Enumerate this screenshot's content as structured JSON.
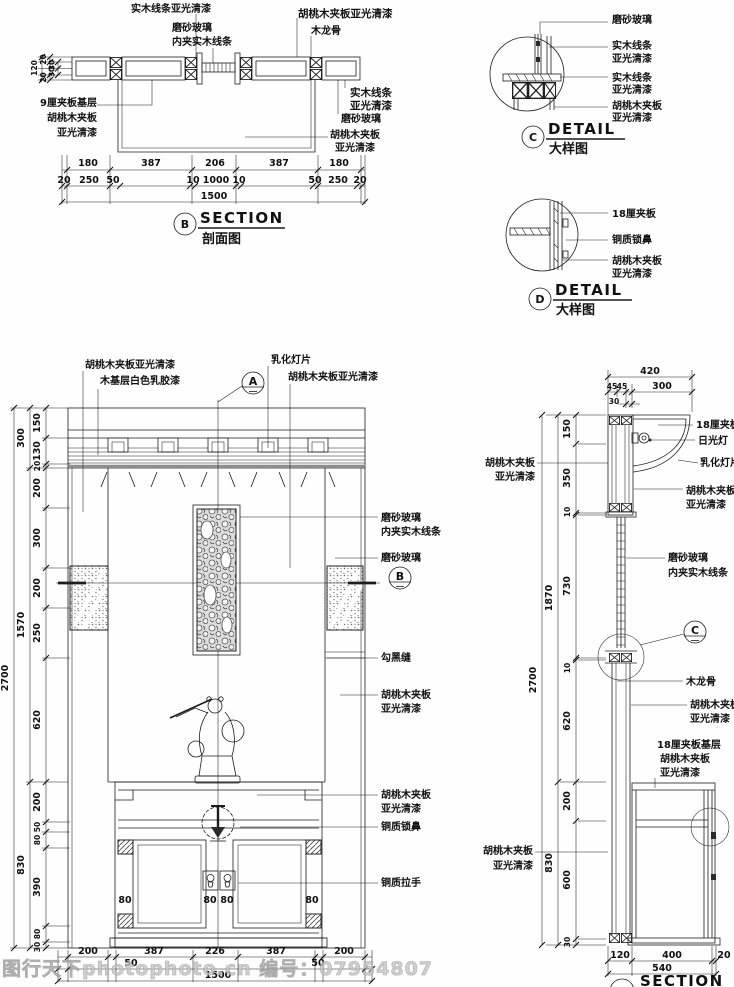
{
  "watermark": "图行天下photophoto.cn 编号：07954807",
  "section_b": {
    "marker": "B",
    "title_en": "SECTION",
    "title_cn": "剖面图",
    "labels": {
      "solid_wood_top": "实木线条亚光清漆",
      "frosted_glass": "磨砂玻璃",
      "inner_wood": "内夹实木线条",
      "walnut_top": "胡桃木夹板亚光清漆",
      "keel": "木龙骨",
      "base9a": "9厘夹板基层",
      "base9b": "胡桃木夹板",
      "base9c": "亚光清漆",
      "solid_r1": "实木线条",
      "solid_r2": "亚光清漆",
      "frosted_r": "磨砂玻璃",
      "walnut_r1": "胡桃木夹板",
      "walnut_r2": "亚光清漆"
    },
    "vdims": [
      "120",
      "20",
      "20",
      "30",
      "30"
    ],
    "row1": [
      "180",
      "387",
      "206",
      "387",
      "180"
    ],
    "row2": [
      "20",
      "250",
      "50",
      "10",
      "1000",
      "10",
      "50",
      "250",
      "20"
    ],
    "total": "1500"
  },
  "detail_c": {
    "marker": "C",
    "title_en": "DETAIL",
    "title_cn": "大样图",
    "labels": {
      "l1": "磨砂玻璃",
      "l2a": "实木线条",
      "l2b": "亚光清漆",
      "l3a": "实木线条",
      "l3b": "亚光清漆",
      "l4a": "胡桃木夹板",
      "l4b": "亚光清漆"
    }
  },
  "detail_d": {
    "marker": "D",
    "title_en": "DETAIL",
    "title_cn": "大样图",
    "labels": {
      "l1": "18厘夹板",
      "l2": "铜质锁鼻",
      "l3a": "胡桃木夹板",
      "l3b": "亚光清漆"
    }
  },
  "elevation": {
    "marker_a": "A",
    "marker_b": "B",
    "top_labels": {
      "t1": "胡桃木夹板亚光清漆",
      "t2": "木基层白色乳胶漆",
      "t3": "乳化灯片",
      "t4": "胡桃木夹板亚光清漆"
    },
    "right_labels": {
      "r1a": "磨砂玻璃",
      "r1b": "内夹实木线条",
      "r2": "磨砂玻璃",
      "r3": "勾黑缝",
      "r4a": "胡桃木夹板",
      "r4b": "亚光清漆",
      "r5a": "胡桃木夹板",
      "r5b": "亚光清漆",
      "r6": "铜质锁鼻",
      "r7": "铜质拉手"
    },
    "dims_outer": "2700",
    "dims_mid": [
      "300",
      "1570",
      "830"
    ],
    "dims_inner": [
      "150",
      "130",
      "20",
      "200",
      "300",
      "200",
      "250",
      "620",
      "200",
      "50",
      "80",
      "390",
      "80",
      "30"
    ],
    "door_dims": [
      "80",
      "80",
      "80",
      "80"
    ],
    "bottom_row1": [
      "200",
      "387",
      "226",
      "387",
      "200"
    ],
    "bottom_row2": [
      "50",
      "50"
    ],
    "bottom_total": "1500"
  },
  "section_a": {
    "marker_c": "C",
    "title_en": "SECTION",
    "labels": {
      "left1a": "胡桃木夹板",
      "left1b": "亚光清漆",
      "r1": "18厘夹板",
      "r2": "日光灯",
      "r3": "乳化灯片",
      "r4a": "胡桃木夹板",
      "r4b": "亚光清漆",
      "r5a": "磨砂玻璃",
      "r5b": "内夹实木线条",
      "r6": "木龙骨",
      "r7a": "胡桃木夹板",
      "r7b": "亚光清漆",
      "r8a": "18厘夹板基层",
      "r8b": "胡桃木夹板",
      "r8c": "亚光清漆",
      "left2a": "胡桃木夹板",
      "left2b": "亚光清漆"
    },
    "top_total": "420",
    "top_row2": [
      "45",
      "45",
      "300"
    ],
    "top_sub": "30",
    "dims_outer": "2700",
    "dims_mid": [
      "1870",
      "830"
    ],
    "dims_inner": [
      "150",
      "350",
      "10",
      "730",
      "10",
      "620",
      "200",
      "600",
      "30"
    ],
    "bottom_row1": [
      "120",
      "400",
      "20"
    ],
    "bottom_total": "540"
  }
}
